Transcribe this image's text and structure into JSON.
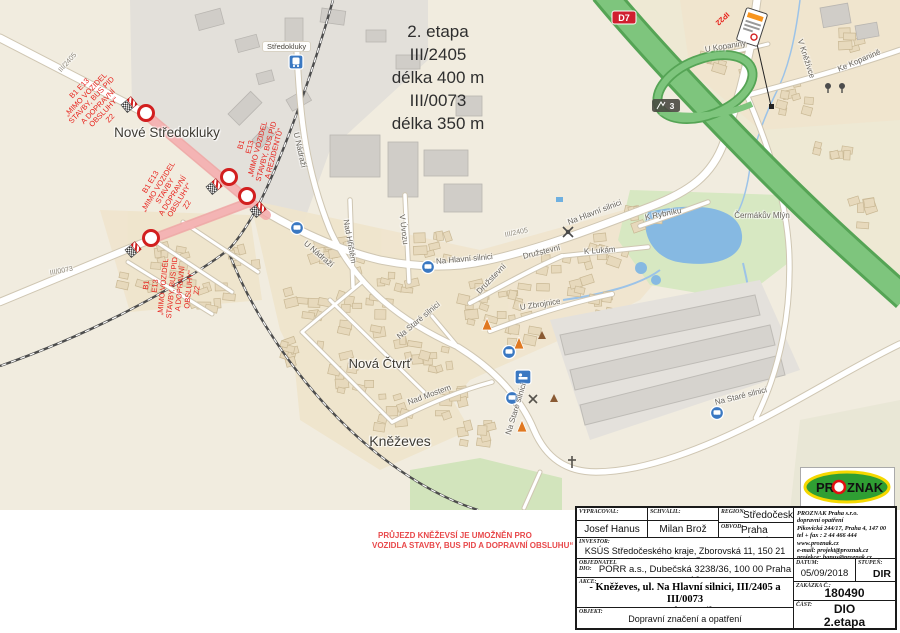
{
  "note": {
    "text": "2. etapa\nIII/2405\ndélka 400 m\nIII/0073\ndélka 350 m"
  },
  "bottom_note": {
    "line1": "PRŮJEZD KNĚŽEVSÍ JE UMOŽNĚN PRO",
    "line2": "VOZIDLA STAVBY, BUS PID A DOPRAVNÍ OBSLUHU“"
  },
  "map": {
    "places": {
      "nove_stredokluky": "Nové\nStředokluky",
      "stredokluky": "Středokluky",
      "knezeves": "Kněževes",
      "nova_ctvrt": "Nová\nČtvrť",
      "cermakuv_mlyn": "Čermákův\nMlýn"
    },
    "streets": {
      "u_nadrazi": "U Nádraží",
      "na_hlavni_silnici": "Na Hlavní silnici",
      "na_stare_silnici": "Na Staré silnici",
      "druzstevni": "Družstevní",
      "k_lukam": "K Lukám",
      "u_zbrojnice": "U Zbrojnice",
      "k_rybniku": "K Rybníku",
      "v_uvozu": "V Úvozu",
      "nad_hristem": "Nad Hřištěm",
      "nad_mostem": "Nad Mostem",
      "v_knezivce": "V Kněžívce",
      "ke_kopanine": "Ke Kopanině",
      "u_kopaniny": "U Kopaniny"
    },
    "road_numbers": {
      "d7": "D7",
      "exit": "3",
      "iii_2405": "III/2405",
      "iii_0073": "III/0073"
    },
    "annotations": {
      "nw": "B1 E13\n„MIMO VOZIDEL\nSTAVBY, BUS PID\nA DOPRAVNÍ\nOBSLUHY“\nZ2",
      "upper": "B1\nE13\n„MIMO VOZIDEL\nSTAVBY, BUS PID\nA REZIDENTŮ“",
      "middle": "B1 E13\n„MIMO VOZIDEL\nSTAVBY\nA DOPRAVNÍ\nOBSLUHY“\nZ2",
      "south": "B1\nE13\n„MIMO VOZIDEL\nSTAVBY, BUS PID\nA DOPRAVNÍ\nOBSLUHY“\nZ2",
      "ip22": "IP22"
    }
  },
  "titleblock": {
    "labels": {
      "vypracoval": "VYPRACOVAL:",
      "schvalil": "SCHVÁLIL:",
      "region": "REGION:",
      "obvod": "OBVOD:",
      "investor": "INVESTOR:",
      "objednatel": "OBJEDNATEL\nDIO:",
      "akce": "AKCE:",
      "objekt": "OBJEKT:",
      "datum": "DATUM:",
      "stupen": "STUPEŇ:",
      "zakazka": "ZAKÁZKA Č.:",
      "cast": "ČÁST:"
    },
    "values": {
      "vypracoval": "Josef Hanus",
      "schvalil": "Milan Brož",
      "region": "Středočeský",
      "obvod": "Praha západ",
      "investor": "KSÚS Středočeského kraje, Zborovská 11, 150 21 Praha 5",
      "objednatel": "PORR a.s., Dubečská 3238/36, 100 00 Praha 10",
      "akce_line1": "- Kněževes, ul. Na Hlavní silnici, III/2405 a III/0073",
      "akce_line2": "oprava komunikace",
      "objekt": "Dopravní značení a opatření",
      "datum": "05/09/2018",
      "stupen": "DIR",
      "zakazka": "180490",
      "cast": "DIO\n2.etapa"
    },
    "company": {
      "name": "PROZNAK  Praha s.r.o.",
      "line2": "dopravní opatření",
      "line3": "Pikovická 244/17, Praha 4, 147 00",
      "line4": "tel + fax : 2 44 466 444",
      "line5": "www.proznak.cz",
      "line6": "e-mail:    projekt@proznak.cz",
      "line7": "projekce: hanus@proznak.cz"
    }
  },
  "logo": {
    "pr": "PR",
    "o": "O",
    "znak": "ZNAK"
  }
}
